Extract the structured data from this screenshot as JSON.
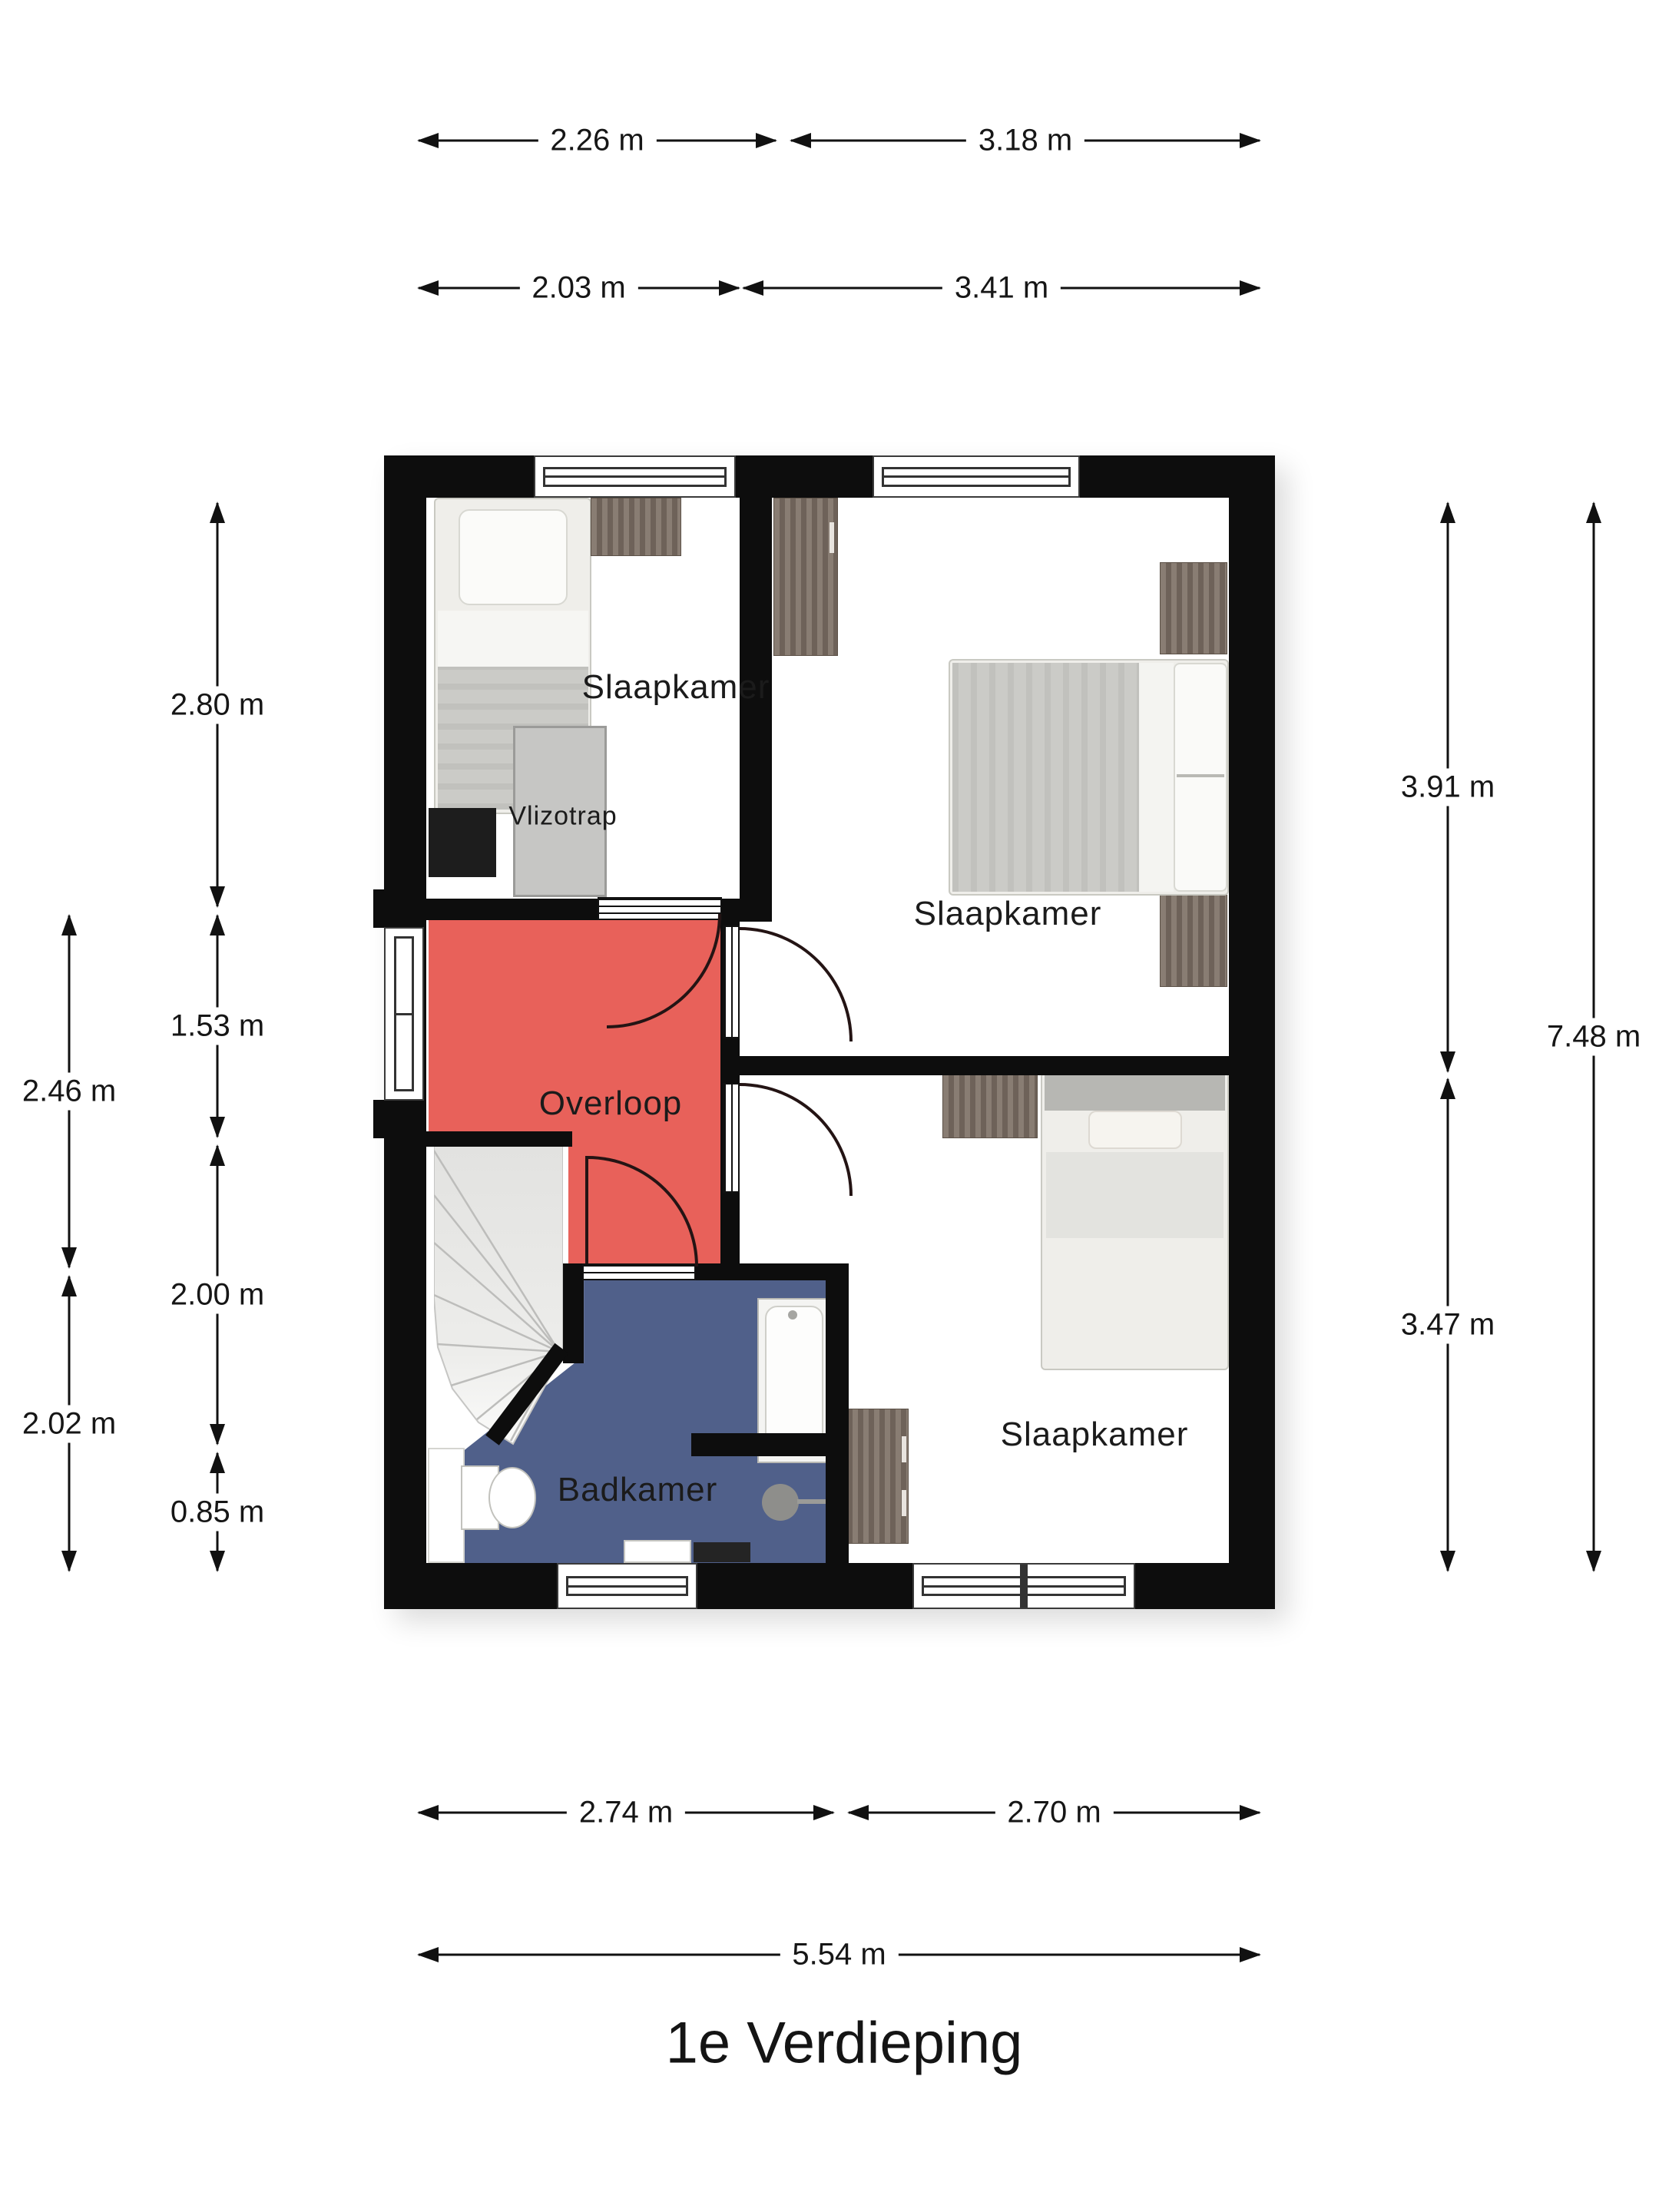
{
  "title": "1e Verdieping",
  "rooms": {
    "bedroom_top_left": "Slaapkamer",
    "bedroom_top_right": "Slaapkamer",
    "bedroom_bottom_right": "Slaapkamer",
    "landing": "Overloop",
    "bathroom": "Badkamer",
    "loft_ladder": "Vlizotrap"
  },
  "dimensions": {
    "top_226": "2.26 m",
    "top_318": "3.18 m",
    "top_203": "2.03 m",
    "top_341": "3.41 m",
    "left_280": "2.80 m",
    "left_153": "1.53 m",
    "left_200": "2.00 m",
    "left_085": "0.85 m",
    "left_246": "2.46 m",
    "left_202": "2.02 m",
    "right_391": "3.91 m",
    "right_347": "3.47 m",
    "right_748": "7.48 m",
    "bottom_274": "2.74 m",
    "bottom_270": "2.70 m",
    "bottom_554": "5.54 m"
  },
  "furniture": [
    "single-bed",
    "desk",
    "loft-ladder-hatch",
    "dresser-black",
    "wardrobe",
    "double-bed",
    "nightstand",
    "nightstand",
    "desk",
    "single-bed",
    "radiator-cabinet",
    "bathtub",
    "toilet",
    "washbasin-counter",
    "shower",
    "sink"
  ],
  "colors": {
    "wall": "#0d0d0d",
    "landing_red": "#e8615a",
    "bathroom_blue": "#50608a",
    "furniture_wood": "#7d7065",
    "door_arc": "#241414",
    "text": "#161616"
  }
}
